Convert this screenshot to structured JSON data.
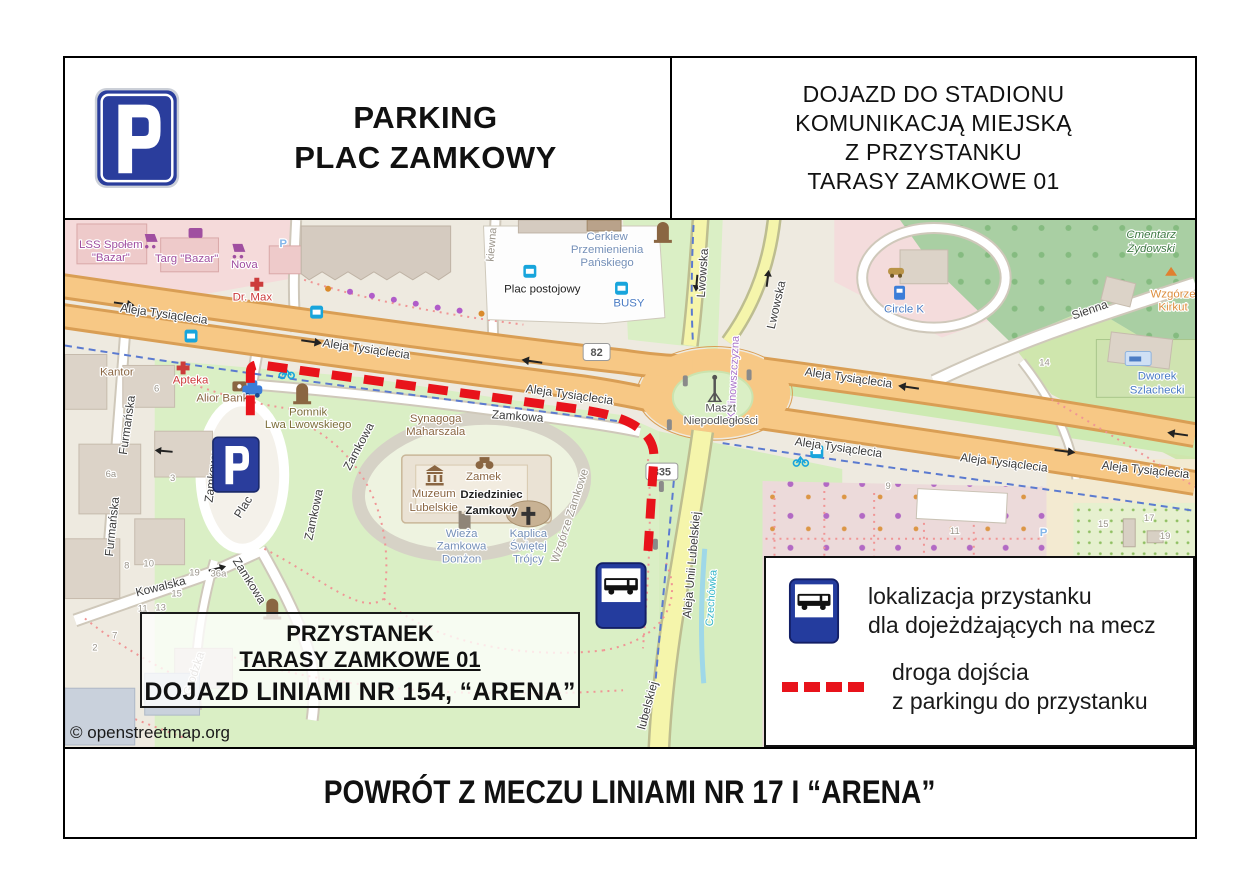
{
  "header": {
    "title": [
      "PARKING",
      "PLAC ZAMKOWY"
    ],
    "right_lines": [
      "DOJAZD DO STADIONU",
      "KOMUNIKACJĄ MIEJSKĄ",
      "Z PRZYSTANKU",
      "TARASY ZAMKOWE 01"
    ]
  },
  "footer": {
    "text": "POWRÓT Z MECZU LINIAMI NR 17 I “ARENA”"
  },
  "map": {
    "copyright": "© openstreetmap.org",
    "info_box": {
      "line1": "PRZYSTANEK",
      "line2": "TARASY ZAMKOWE 01",
      "line3": "DOJAZD LINIAMI NR 154, “ARENA”"
    },
    "legend": {
      "stop_line1": "lokalizacja przystanku",
      "stop_line2": "dla dojeżdżających na mecz",
      "route_line1": "droga dojścia",
      "route_line2": "z parkingu do przystanku"
    },
    "shields": {
      "r82": "82",
      "r835": "835"
    },
    "streets": {
      "aleja": "Aleja Tysiąclecia",
      "zamkowa": "Zamkowa",
      "lwowska": "Lwowska",
      "unii": "Aleja Unii Lubelskiej",
      "unii_partial": "lubelskiej",
      "furmanska": "Furmańska",
      "kowalska": "Kowalska",
      "grodzka": "Grodzka",
      "sienna": "Sienna",
      "kalinowszczyzna": "Kalinowszczyzna",
      "czechowka": "Czechówka",
      "kiewna": "kiewna",
      "plac": "Plac",
      "zamkowy": "Zamkowy"
    },
    "pois": {
      "lss1": "LSS Społem",
      "lss2": "\"Bazar\"",
      "targ": "Targ \"Bazar\"",
      "nova": "Nova",
      "drmax": "Dr. Max",
      "kantor": "Kantor",
      "apteka": "Apteka",
      "alior": "Alior Bank",
      "pomnik1": "Pomnik",
      "pomnik2": "Lwa Lwowskiego",
      "syn1": "Synagoga",
      "syn2": "Maharszala",
      "cerkiew1": "Cerkiew",
      "cerkiew2": "Przemienienia",
      "cerkiew3": "Pańskiego",
      "placpost": "Plac postojowy",
      "busy": "BUSY",
      "zamek": "Zamek",
      "muzeum1": "Muzeum",
      "muzeum2": "Lubelskie",
      "dzie1": "Dziedziniec",
      "dzie2": "Zamkowy",
      "wieza1": "Wieża",
      "wieza2": "Zamkowa",
      "wieza3": "Donżon",
      "kap1": "Kaplica",
      "kap2": "Świętej",
      "kap3": "Trójcy",
      "wzgorze": "Wzgórze Zamkowe",
      "maszt1": "Maszt",
      "maszt2": "Niepodległości",
      "cm1": "Cmentarz",
      "cm2": "Żydowski",
      "kirkut1": "Wzgórze",
      "kirkut2": "Kirkut",
      "circlek": "Circle K",
      "dworek1": "Dworek",
      "dworek2": "Szlachecki",
      "p_small": "P"
    },
    "numbers": [
      "6a",
      "3",
      "8",
      "10",
      "19",
      "36a",
      "15",
      "13",
      "11",
      "14",
      "9",
      "11",
      "15",
      "17",
      "19",
      "7",
      "2",
      "6"
    ],
    "colors": {
      "route_red": "#e8131b",
      "sign_blue": "#2a3d9c",
      "road_primary": "#f7c885",
      "road_minor_yellow": "#f5f5ab",
      "park_green": "#daefc5",
      "cemetery_green": "#a9cfa3"
    }
  }
}
